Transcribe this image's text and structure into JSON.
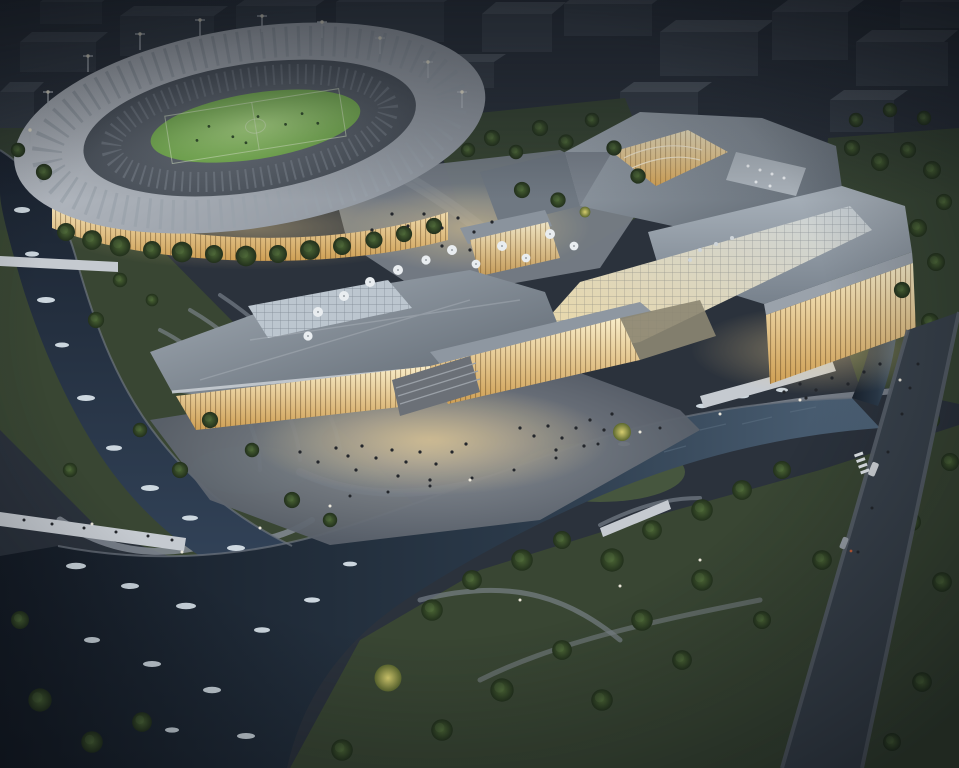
{
  "scene": {
    "description": "Aerial dusk rendering of a riverfront sports and events district: an oval stadium with a lit green pitch, a large angular events center with glowing glass facades, whitewater rivers, bridges, parkland and a perimeter street",
    "elements": [
      "stadium",
      "football-pitch",
      "floodlight-masts",
      "stadium-concourse-glow",
      "events-center",
      "glass-curtain-facades",
      "roof-skylights",
      "rooftop-courtyard",
      "rooftop-terrace",
      "public-plaza",
      "patio-umbrellas",
      "visitor-crowds",
      "whitewater-river",
      "rapids",
      "lagoon",
      "pedestrian-bridges",
      "winding-footpaths",
      "parkland-trees",
      "illuminated-trees",
      "city-context-blocks",
      "perimeter-street",
      "cars"
    ]
  },
  "palette": {
    "ground": "#2b323c",
    "park": "#3a4833",
    "parkLit": "#5c7440",
    "waterDark": "#141b25",
    "waterMid": "#2b3a4a",
    "waterLight": "#4e6378",
    "rapids": "#dfe9f0",
    "roofLight": "#a6afb8",
    "roofMid": "#77818c",
    "roofDark": "#59626c",
    "glass": "#bcc6cf",
    "glowBright": "#f8ecc8",
    "glowWarm": "#eccf92",
    "glowDeep": "#cfa055",
    "pitch": "#7ab254",
    "pitchLight": "#b0de87",
    "stadiumRing": "#b7bdc4",
    "stadiumBowl": "#5f6670",
    "path": "#858c95",
    "bridge": "#c5cad0",
    "road": "#39424c",
    "sidewalk": "#5a626c",
    "tree": "#22301c",
    "treeHi": "#4a6434",
    "treeLit": "#d6cd6f",
    "contextTop": "#555d67",
    "contextSide": "#3e4650",
    "umbrella": "#e9edf0",
    "people": "#23262b",
    "bank": "#6d757f"
  }
}
